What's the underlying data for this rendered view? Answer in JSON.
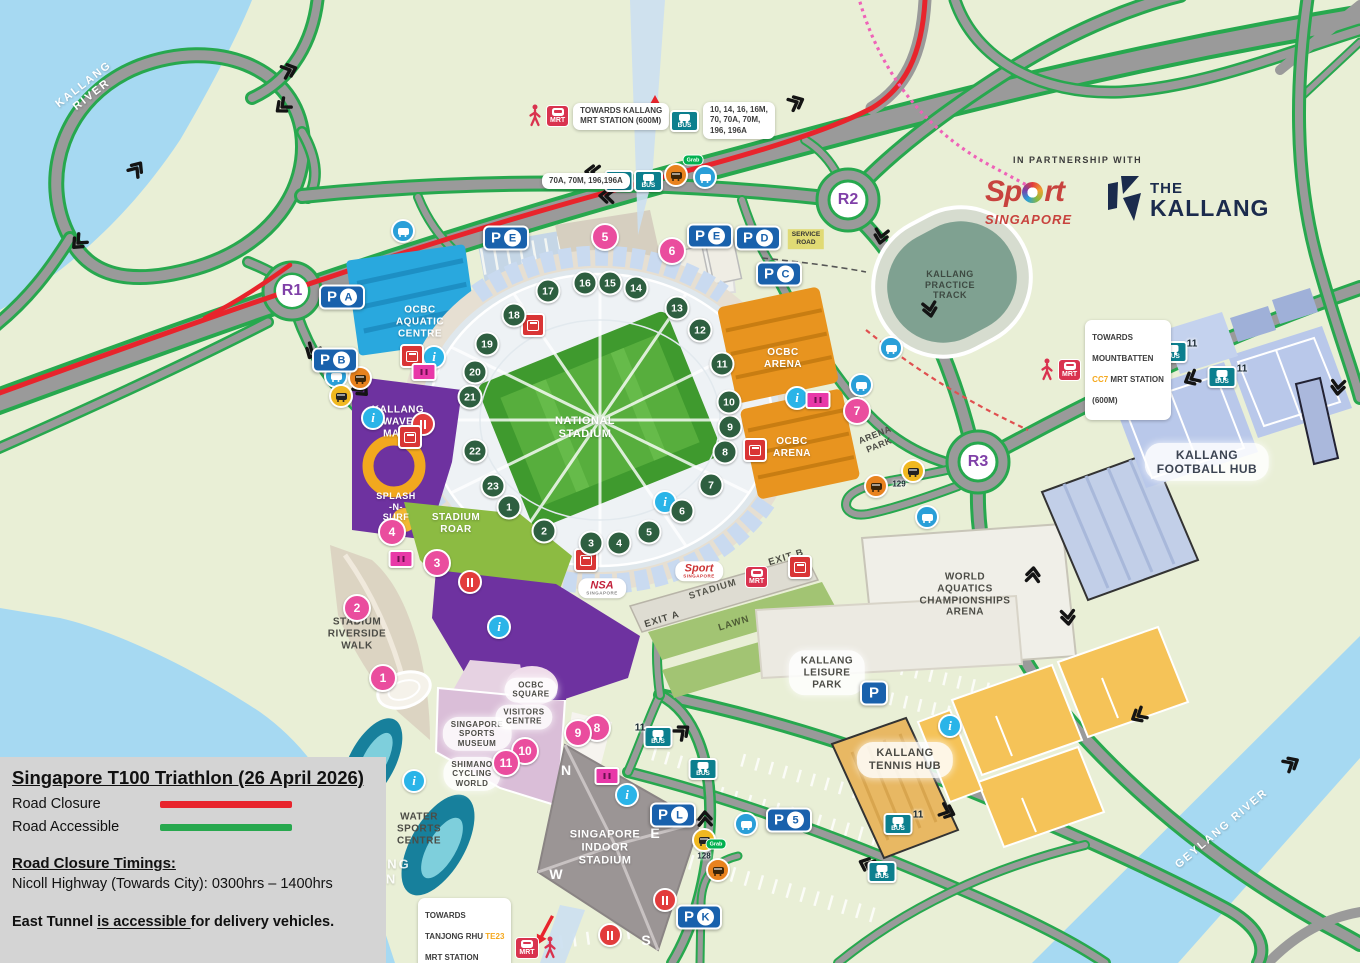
{
  "legend": {
    "title": "Singapore T100 Triathlon (26 April 2026)",
    "items": [
      {
        "label": "Road Closure",
        "color": "#e8242c"
      },
      {
        "label": "Road Accessible",
        "color": "#27a84e"
      }
    ],
    "timings_heading": "Road Closure Timings:",
    "timing_line": "Nicoll Highway (Towards City): 0300hrs – 1400hrs",
    "note_prefix": "East Tunnel ",
    "note_underlined": "is accessible ",
    "note_suffix": "for delivery vehicles."
  },
  "partnership": {
    "label": "IN PARTNERSHIP WITH",
    "sport_p1": "Sp",
    "sport_p2": "rt",
    "sport_sub": "SINGAPORE",
    "kallang_the": "THE",
    "kallang_name": "KALLANG"
  },
  "rivers": {
    "kallang": "KALLANG\nRIVER",
    "geylang": "GEYLANG RIVER",
    "basin": "KALLANG\nBASIN"
  },
  "venues": {
    "aquatic": "OCBC\nAQUATIC\nCENTRE",
    "wave_mall_upper": "KALLANG\nWAVE\nMALL",
    "wave_mall_lower": "KALLANG\nWAVE\nMALL",
    "splash": "SPLASH\n-N-\nSURF",
    "stadium_roar": "STADIUM\nROAR",
    "national_stadium": "NATIONAL\nSTADIUM",
    "ocbc_arena_n": "OCBC\nARENA",
    "ocbc_arena_s": "OCBC\nARENA",
    "practice_track": "KALLANG\nPRACTICE\nTRACK",
    "arena_park": "ARENA\nPARK",
    "football_hub": "KALLANG\nFOOTBALL HUB",
    "aquatics_arena": "WORLD\nAQUATICS\nCHAMPIONSHIPS\nARENA",
    "leisure_park": "KALLANG\nLEISURE\nPARK",
    "tennis_hub": "KALLANG\nTENNIS HUB",
    "riverside_walk": "STADIUM\nRIVERSIDE\nWALK",
    "water_sports": "WATER\nSPORTS\nCENTRE",
    "sports_museum": "SINGAPORE\nSPORTS\nMUSEUM",
    "visitors_centre": "VISITORS\nCENTRE",
    "shimano": "SHIMANO\nCYCLING\nWORLD",
    "ocbc_square": "OCBC\nSQUARE",
    "indoor_stadium": "SINGAPORE\nINDOOR\nSTADIUM"
  },
  "roundabouts": {
    "r1": "R1",
    "r2": "R2",
    "r3": "R3"
  },
  "parking": {
    "p": "P",
    "a": "A",
    "b": "B",
    "c": "C",
    "d": "D",
    "e": "E",
    "l": "L",
    "k": "K",
    "five": "5"
  },
  "gates": [
    "1",
    "2",
    "3",
    "4",
    "5",
    "6",
    "7",
    "8",
    "9",
    "10",
    "11",
    "12",
    "13",
    "14",
    "15",
    "16",
    "17",
    "18",
    "19",
    "20",
    "21",
    "22",
    "23"
  ],
  "locations": [
    "1",
    "2",
    "3",
    "4",
    "5",
    "6",
    "7",
    "8",
    "9",
    "10",
    "11"
  ],
  "transit": {
    "mrt": "MRT",
    "bus": "BUS",
    "kallang_sign": "TOWARDS KALLANG\nMRT STATION (600M)",
    "routes_top": "10, 14, 16, 16M,\n70, 70A, 70M,\n196, 196A",
    "routes_left": "70A, 70M, 196,196A",
    "mb_line1": "TOWARDS",
    "mb_line2": "MOUNTBATTEN",
    "mb_code": "CC7",
    "mb_line3": " MRT STATION",
    "mb_line4": "(600M)",
    "t_line1": "TOWARDS",
    "t_line2a": "TANJONG RHU ",
    "t_code": "TE23",
    "t_line3": "MRT STATION",
    "t_line4": "(350M)",
    "stop_11": "11",
    "taxi_128": "128",
    "taxi_129": "129",
    "grab": "Grab"
  },
  "stadium_labels": {
    "exit_a": "EXIT A",
    "exit_b": "EXIT B",
    "walkway": "STADIUM",
    "lawn": "LAWN",
    "service_road": "SERVICE\nROAD",
    "compass_n": "N",
    "compass_e": "E",
    "compass_w": "W",
    "compass_s": "S"
  },
  "logos_small": {
    "nsa": "NSA",
    "nsa_sub": "SINGAPORE",
    "sport": "Sport",
    "sport_sub": "SINGAPORE"
  },
  "icons": {
    "info_glyph": "i"
  },
  "colors": {
    "closure": "#e8242c",
    "accessible": "#27a84e",
    "parking_blue": "#1961ac",
    "gate_green": "#2e5f40",
    "location_pink": "#ea4d9e",
    "bus_teal": "#0c7f8e",
    "mrt_red": "#d9334f",
    "info_blue": "#2ab4e8",
    "roundabout_purple": "#8040a8"
  }
}
